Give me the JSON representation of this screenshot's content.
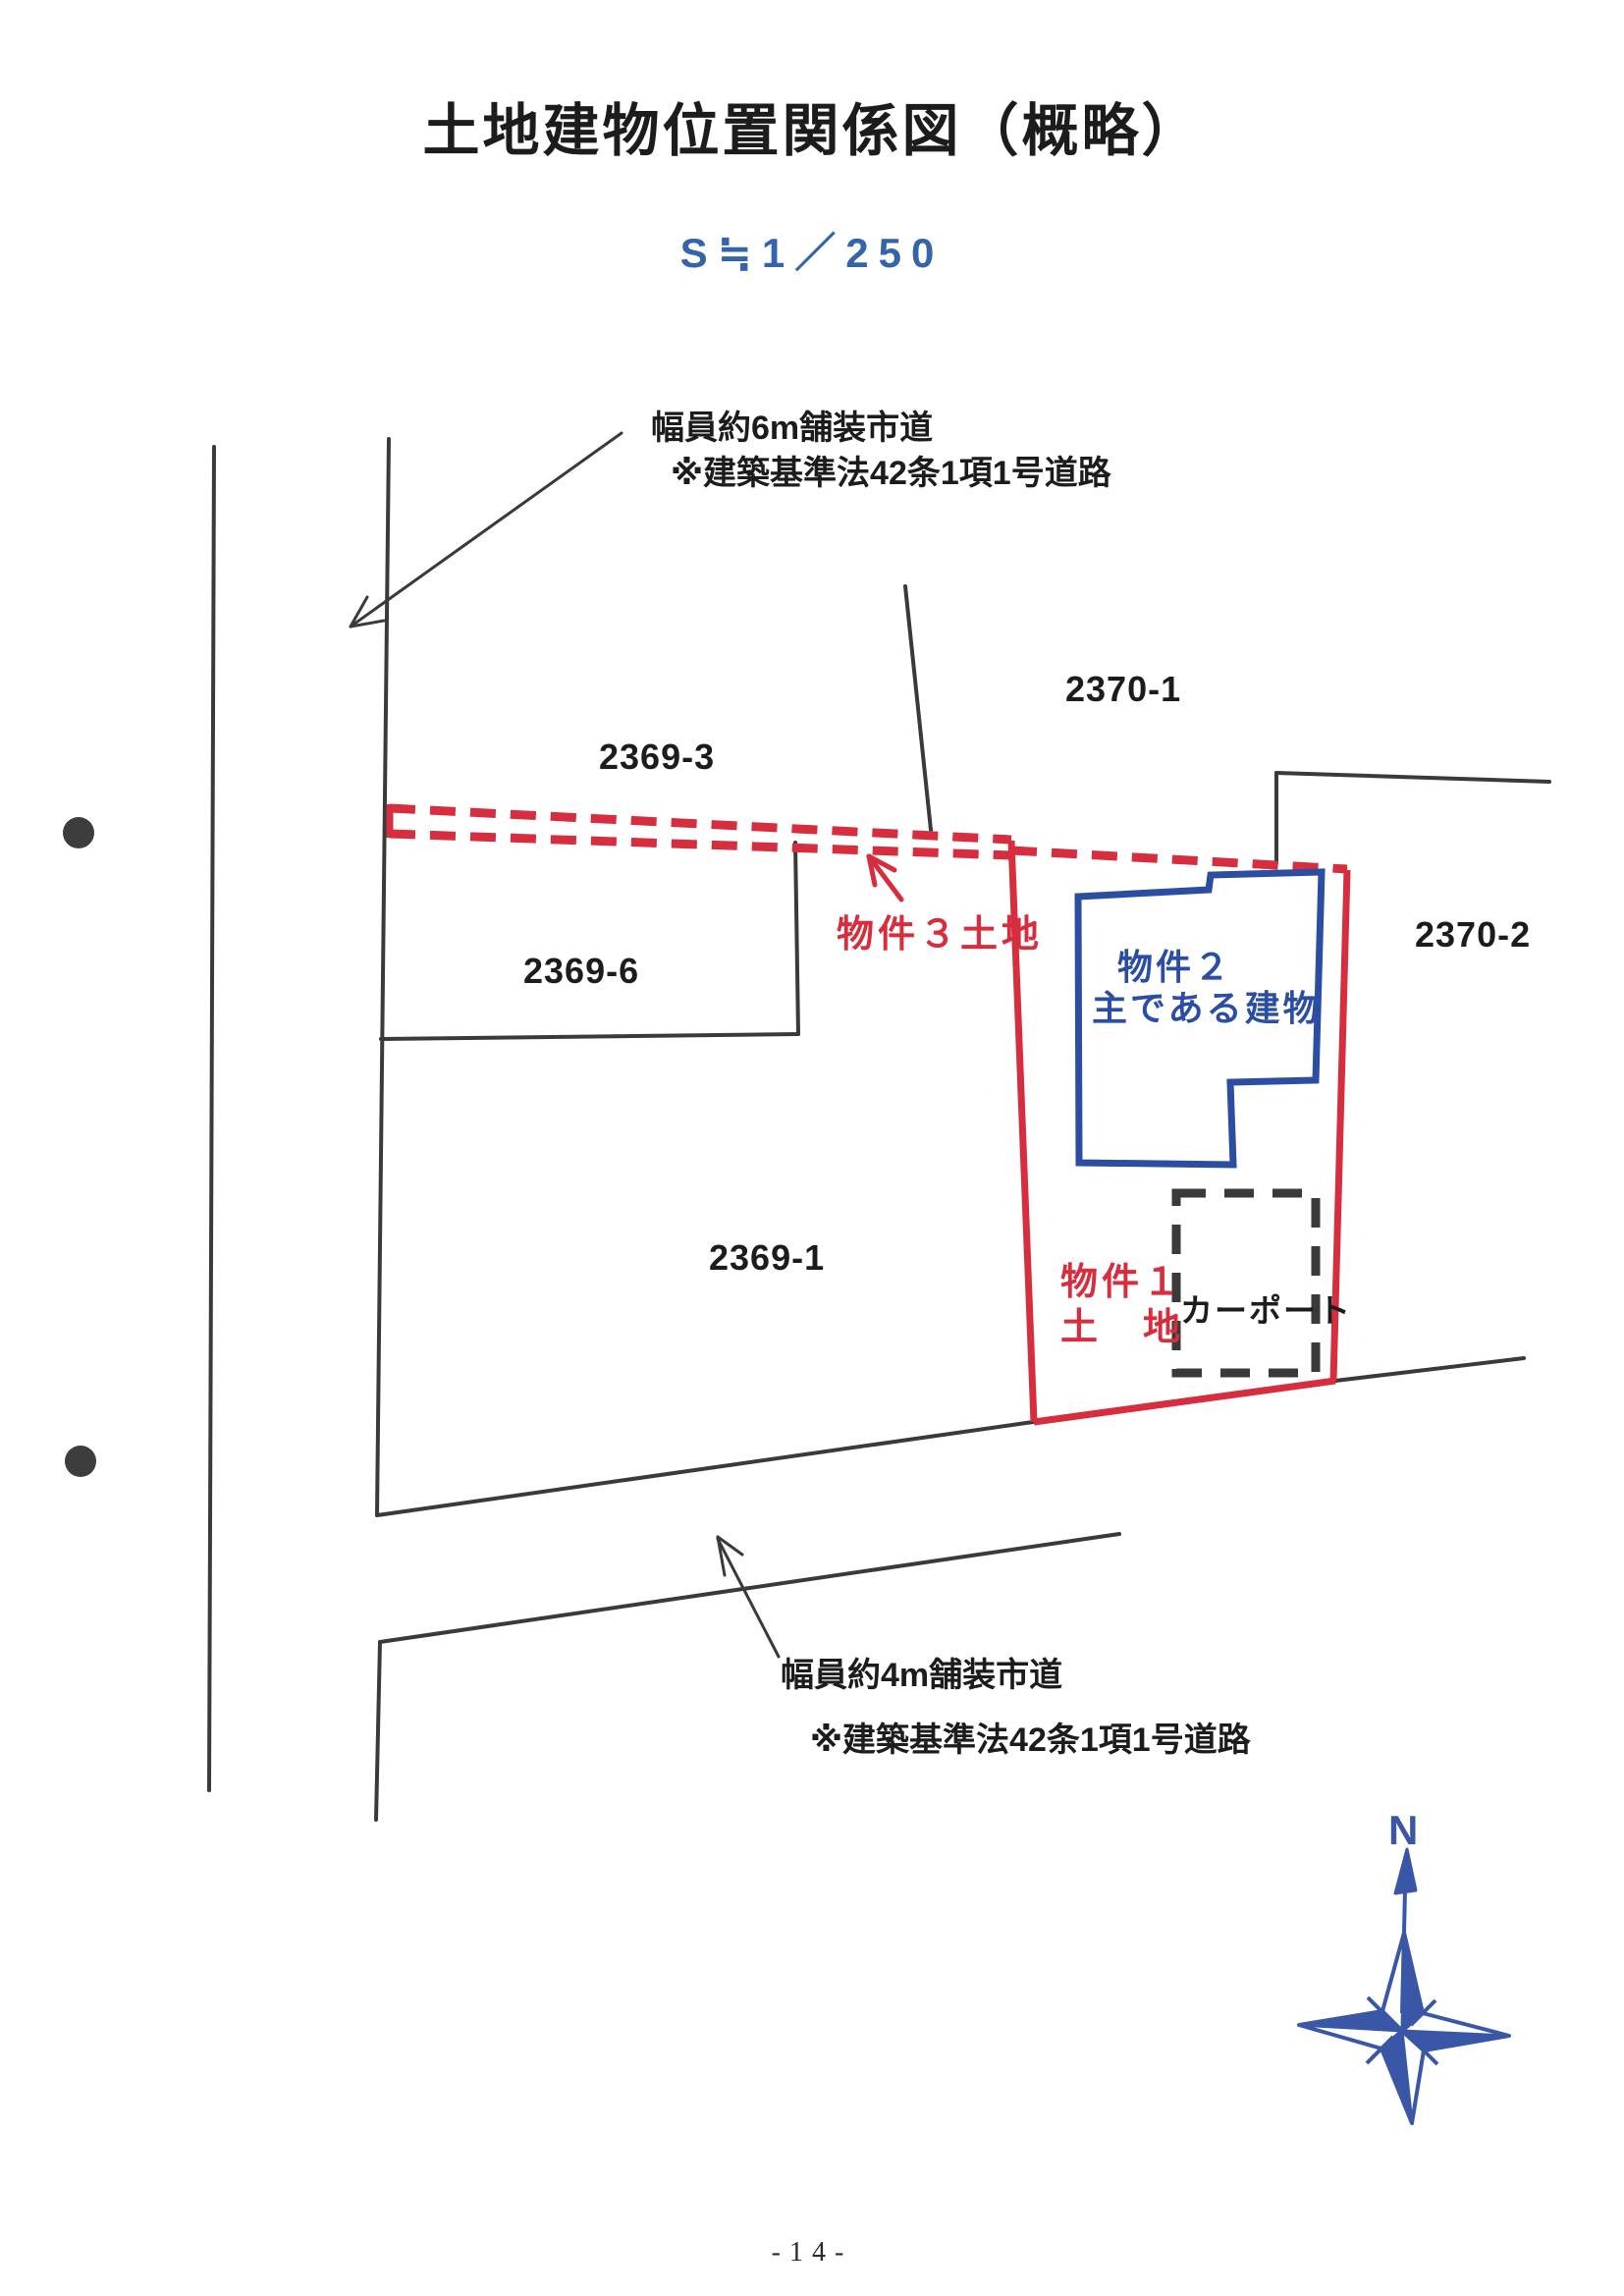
{
  "page": {
    "title": "土地建物位置関係図（概略）",
    "scale": "S≒1／250",
    "page_number": "-14-"
  },
  "annotations": {
    "top_road": {
      "line1": "幅員約6m舗装市道",
      "line2": "※建築基準法42条1項1号道路"
    },
    "bottom_road": {
      "line1": "幅員約4m舗装市道",
      "line2": "※建築基準法42条1項1号道路"
    }
  },
  "parcels": {
    "p2369_3": "2369-3",
    "p2370_1": "2370-1",
    "p2369_6": "2369-6",
    "p2370_2": "2370-2",
    "p2369_1": "2369-1"
  },
  "properties": {
    "property3_label": "物件３土地",
    "property2_line1": "物件２",
    "property2_line2": "主である建物",
    "property1_line1": "物件１",
    "property1_line2": "土　地",
    "carport_label": "カーポート"
  },
  "compass": {
    "north_label": "N",
    "icon": "compass-rose-icon"
  },
  "colors": {
    "boundary_black": "#3a3a3a",
    "parcel_red": "#d62e3e",
    "building_blue": "#2b4ea2",
    "scale_blue": "#3465a8",
    "compass_blue": "#3a57a7",
    "text_black": "#1c1c1c",
    "dot_gray": "#3d3d3d"
  }
}
